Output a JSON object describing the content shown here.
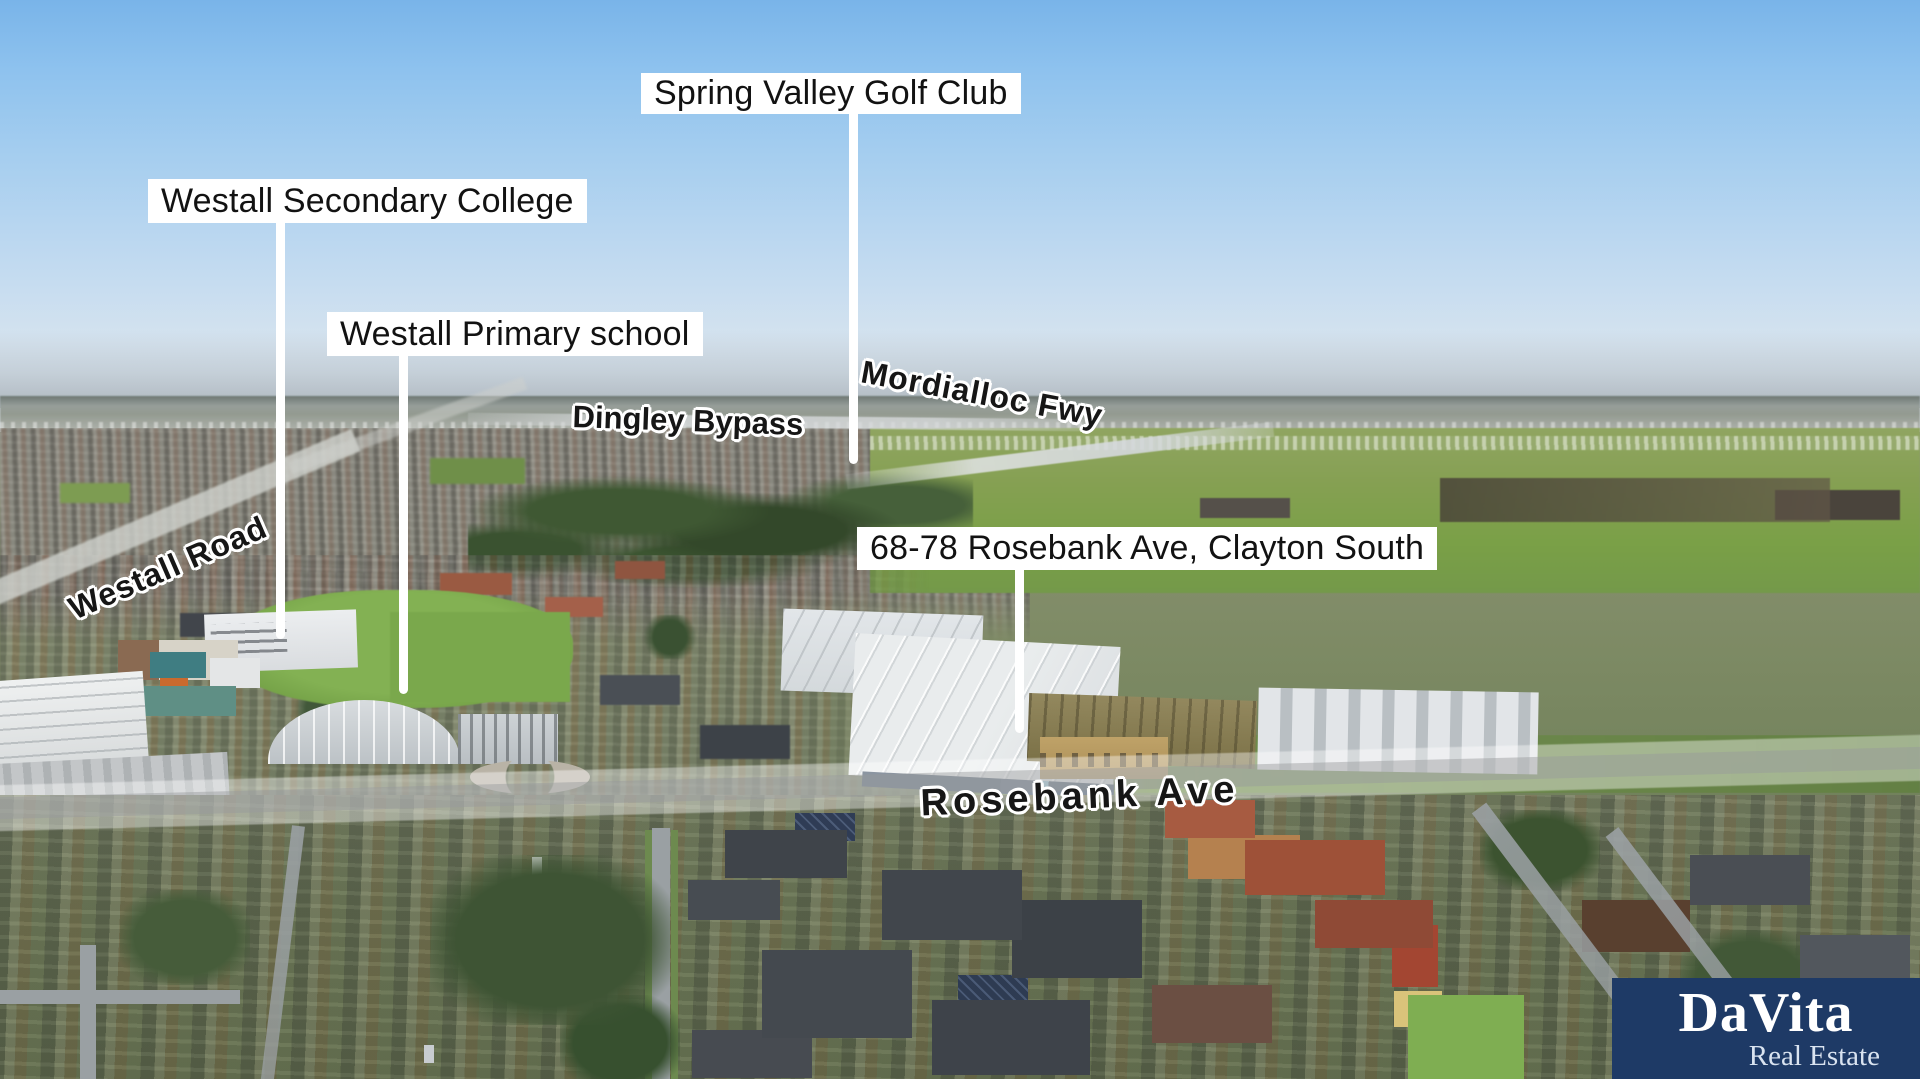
{
  "annotations": {
    "boxed_labels": [
      {
        "id": "spring-valley-golf-club",
        "text": "Spring Valley Golf Club"
      },
      {
        "id": "westall-secondary-college",
        "text": "Westall Secondary College"
      },
      {
        "id": "westall-primary-school",
        "text": "Westall Primary school"
      },
      {
        "id": "property-address",
        "text": "68-78 Rosebank Ave, Clayton South"
      }
    ],
    "road_labels": [
      {
        "id": "mordialloc-fwy",
        "text": "Mordialloc Fwy"
      },
      {
        "id": "dingley-bypass",
        "text": "Dingley Bypass"
      },
      {
        "id": "westall-road",
        "text": "Westall Road"
      },
      {
        "id": "rosebank-ave",
        "text": "Rosebank Ave"
      }
    ]
  },
  "branding": {
    "name": "DaVita",
    "tagline": "Real Estate",
    "panel_color": "#1e3a66",
    "name_color": "#ffffff",
    "tagline_color": "#d9e3f0"
  },
  "palette": {
    "sky_top": "#79b4e9",
    "sky_horizon": "#dde5ea",
    "sea_haze": "#a3acb4",
    "field_green": "#7aa047",
    "tree_dark": "#3c5430",
    "roof_light": "#e8ebed",
    "roof_cream": "#eae2c9",
    "roof_terracotta": "#9e5138",
    "roof_slate": "#41464c",
    "road_highlight": "rgba(255,255,255,0.4)",
    "label_background": "#ffffff",
    "label_text": "#121212",
    "leader_line": "#ffffff"
  }
}
